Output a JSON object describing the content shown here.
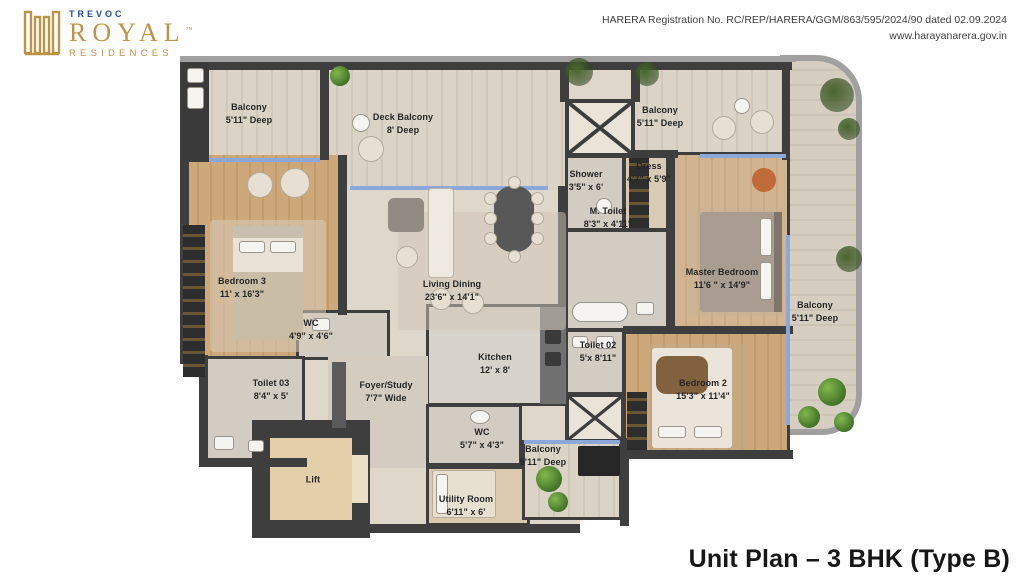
{
  "brand": {
    "top": "TREVOC",
    "name": "ROYAL",
    "tm": "™",
    "sub": "RESIDENCES"
  },
  "registration": {
    "line1": "HARERA Registration No. RC/REP/HARERA/GGM/863/595/2024/90 dated 02.09.2024",
    "line2": "www.harayanarera.gov.in"
  },
  "title": "Unit Plan – 3 BHK (Type B)",
  "rooms": {
    "balcony_tl": {
      "name": "Balcony",
      "dims": "5'11\" Deep"
    },
    "deck_balcony": {
      "name": "Deck Balcony",
      "dims": "8' Deep"
    },
    "balcony_tr": {
      "name": "Balcony",
      "dims": "5'11\" Deep"
    },
    "bedroom3": {
      "name": "Bedroom 3",
      "dims": "11' x 16'3\""
    },
    "living": {
      "name": "Living Dining",
      "dims": "23'6\" x 14'1\""
    },
    "shower": {
      "name": "Shower",
      "dims": "3'5\" x 6'"
    },
    "dress": {
      "name": "Dress",
      "dims": "4'7\" x 5'9\""
    },
    "m_toilet": {
      "name": "M. Toilet",
      "dims": "8'3\" x 4'11\""
    },
    "master": {
      "name": "Master Bedroom",
      "dims": "11'6 \" x 14'9\""
    },
    "balcony_right": {
      "name": "Balcony",
      "dims": "5'11\" Deep"
    },
    "wc_top": {
      "name": "WC",
      "dims": "4'9\" x 4'6\""
    },
    "toilet03": {
      "name": "Toilet 03",
      "dims": "8'4\" x 5'"
    },
    "foyer": {
      "name": "Foyer/Study",
      "dims": "7'7\" Wide"
    },
    "kitchen": {
      "name": "Kitchen",
      "dims": "12' x 8'"
    },
    "toilet02": {
      "name": "Toilet 02",
      "dims": "5'x 8'11\""
    },
    "bedroom2": {
      "name": "Bedroom 2",
      "dims": "15'3\" x 11'4\""
    },
    "wc_bottom": {
      "name": "WC",
      "dims": "5'7\" x 4'3\""
    },
    "balcony_bottom": {
      "name": "Balcony",
      "dims": "5'11\" Deep"
    },
    "utility": {
      "name": "Utility Room",
      "dims": "6'11\" x 6'"
    },
    "lift": {
      "name": "Lift",
      "dims": ""
    }
  },
  "colors": {
    "gold": "#bd9345",
    "blue": "#274d9b",
    "wall": "#3e3e3e",
    "glass": "#8ca8da",
    "wood": "#c8a06f",
    "plank": "#d8d1c4",
    "cream": "#ded7ca"
  }
}
